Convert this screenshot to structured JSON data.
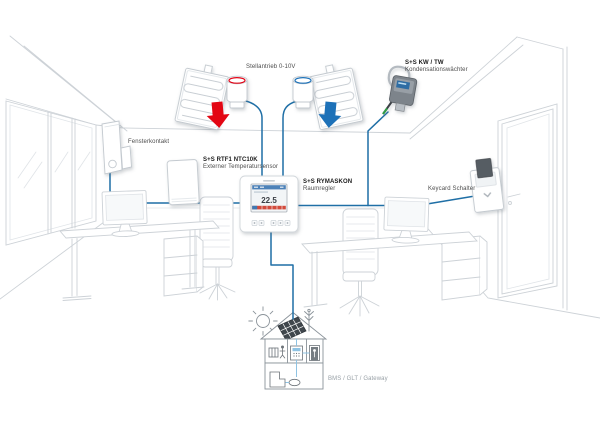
{
  "device_labels": {
    "actuator": "Stellantrieb 0-10V",
    "condensation_monitor": {
      "title": "S+S KW / TW",
      "subtitle": "Kondensationswächter"
    },
    "window_contact": "Fensterkontakt",
    "external_temp_sensor": {
      "title": "S+S RTF1 NTC10K",
      "subtitle": "Externer Temperatursensor"
    },
    "room_controller": {
      "title": "S+S RYMASKON",
      "subtitle": "Raumregler"
    },
    "keycard_switch": "Keycard Schalter",
    "bms_gateway": "BMS / GLT / Gateway"
  },
  "room_controller_display": {
    "temperature": "22.5"
  },
  "colors": {
    "connection_line": "#1f6fa6",
    "heating_arrow": "#e30613",
    "cooling_arrow": "#1d71b8",
    "building_link": "#8fc3e3",
    "sketch_line": "#cdd2d7"
  },
  "icons": {
    "heating": "red-down-arrow-icon",
    "cooling": "blue-down-arrow-icon",
    "solar": "solar-panel-icon",
    "sun": "sun-icon",
    "antenna": "antenna-icon"
  }
}
